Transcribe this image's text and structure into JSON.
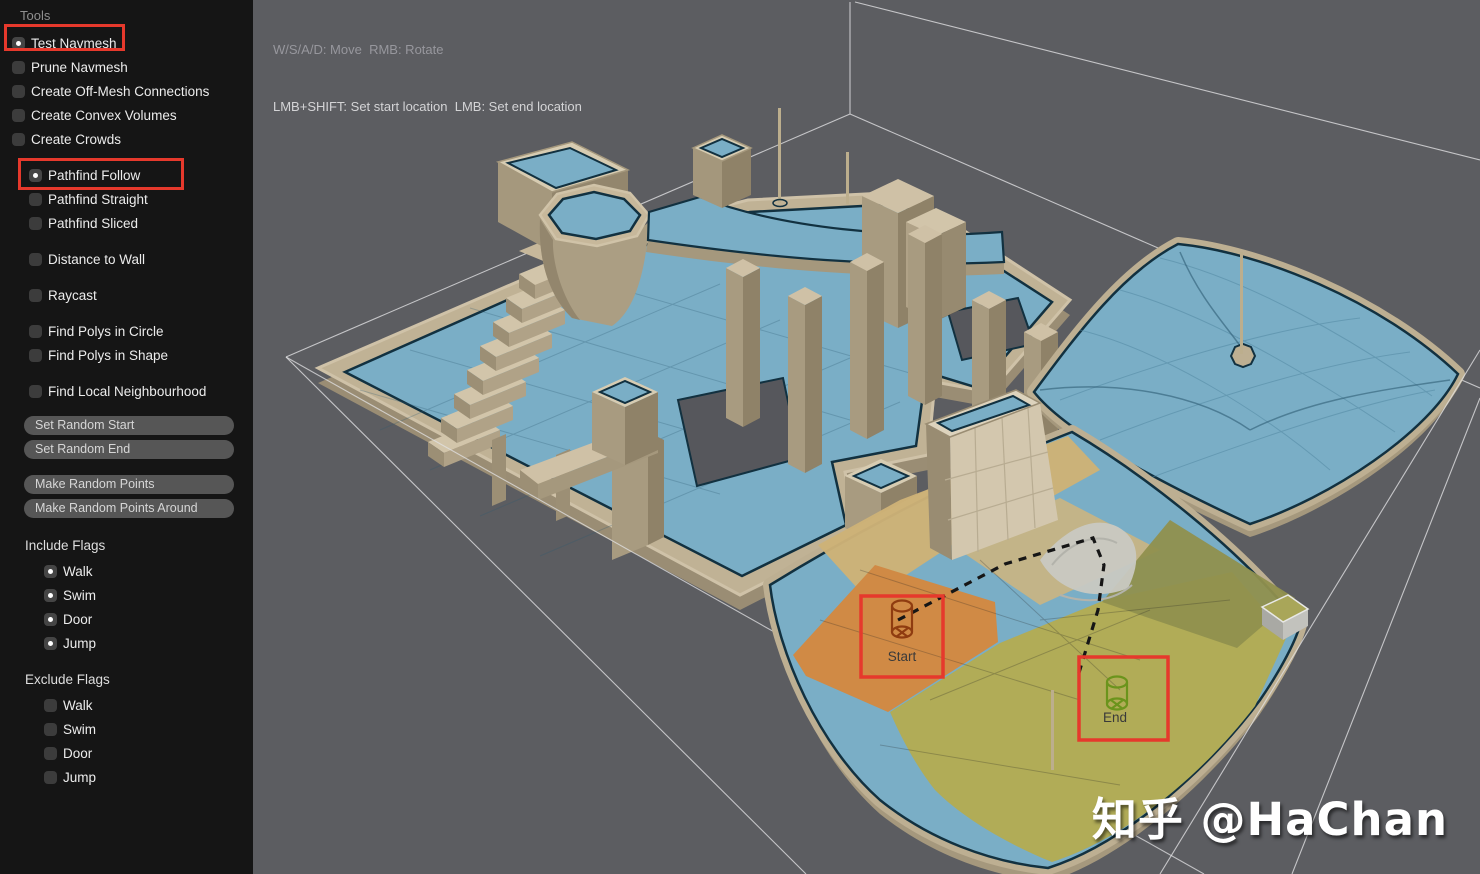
{
  "sidebar": {
    "title": "Tools",
    "tools": [
      {
        "label": "Test Navmesh",
        "checked": true,
        "annotated": true
      },
      {
        "label": "Prune Navmesh",
        "checked": false
      },
      {
        "label": "Create Off-Mesh Connections",
        "checked": false
      },
      {
        "label": "Create Convex Volumes",
        "checked": false
      },
      {
        "label": "Create Crowds",
        "checked": false
      }
    ],
    "modes": [
      {
        "label": "Pathfind Follow",
        "checked": true,
        "annotated": true
      },
      {
        "label": "Pathfind Straight",
        "checked": false
      },
      {
        "label": "Pathfind Sliced",
        "checked": false
      },
      {
        "label": "Distance to Wall",
        "checked": false
      },
      {
        "label": "Raycast",
        "checked": false
      },
      {
        "label": "Find Polys in Circle",
        "checked": false
      },
      {
        "label": "Find Polys in Shape",
        "checked": false
      },
      {
        "label": "Find Local Neighbourhood",
        "checked": false
      }
    ],
    "buttons": [
      "Set Random Start",
      "Set Random End",
      "Make Random Points",
      "Make Random Points Around"
    ],
    "include_flags": {
      "title": "Include Flags",
      "items": [
        {
          "label": "Walk",
          "checked": true
        },
        {
          "label": "Swim",
          "checked": true
        },
        {
          "label": "Door",
          "checked": true
        },
        {
          "label": "Jump",
          "checked": true
        }
      ]
    },
    "exclude_flags": {
      "title": "Exclude Flags",
      "items": [
        {
          "label": "Walk",
          "checked": false
        },
        {
          "label": "Swim",
          "checked": false
        },
        {
          "label": "Door",
          "checked": false
        },
        {
          "label": "Jump",
          "checked": false
        }
      ]
    }
  },
  "viewport": {
    "help_line1": "W/S/A/D: Move  RMB: Rotate",
    "help_line2": "LMB+SHIFT: Set start location  LMB: Set end location",
    "watermark": "知乎 @HaChan",
    "markers": {
      "start": "Start",
      "end": "End"
    }
  },
  "annotations": {
    "color": "#e6392c",
    "highlighted": [
      "Test Navmesh",
      "Pathfind Follow",
      "Start marker",
      "End marker"
    ]
  },
  "colors": {
    "viewport_background": "#5c5d61",
    "sidebar_background": "#151515",
    "navmesh_blue": "#7aaec6",
    "navmesh_edge": "#123140",
    "geometry_tan": "#c7b89b",
    "path_orange_zone": "#d08a45",
    "path_yellow_zone": "#b1ac57",
    "start_marker": "#8f3c10",
    "end_marker": "#6b941c",
    "path_line": "#161616",
    "wireframe": "#e3e3e5"
  }
}
